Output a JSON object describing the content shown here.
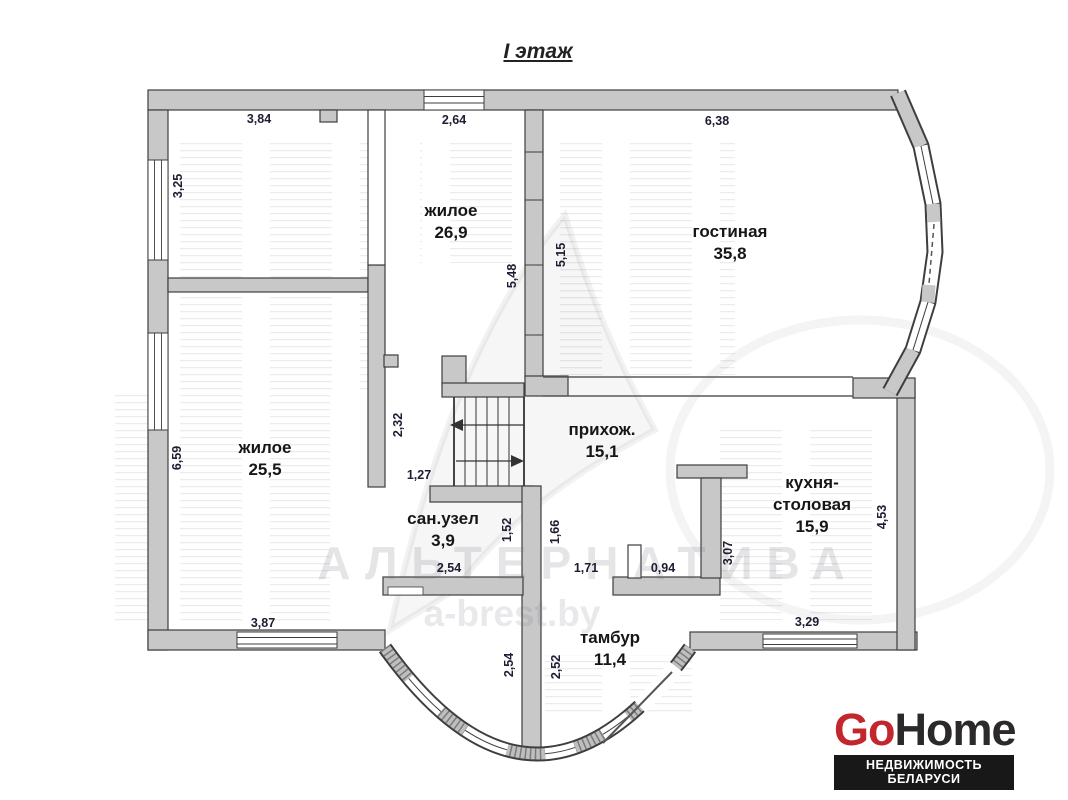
{
  "title": "I этаж",
  "rooms": [
    {
      "name": "жилое",
      "area": "26,9"
    },
    {
      "name": "гостиная",
      "area": "35,8"
    },
    {
      "name": "жилое",
      "area": "25,5"
    },
    {
      "name": "прихож.",
      "area": "15,1"
    },
    {
      "name": "сан.узел",
      "area": "3,9"
    },
    {
      "name": "кухня-",
      "name2": "столовая",
      "area": "15,9"
    },
    {
      "name": "тамбур",
      "area": "11,4"
    }
  ],
  "dims": [
    {
      "v": "3,84"
    },
    {
      "v": "2,64"
    },
    {
      "v": "6,38"
    },
    {
      "v": "3,25"
    },
    {
      "v": "6,59"
    },
    {
      "v": "5,48"
    },
    {
      "v": "5,15"
    },
    {
      "v": "2,32"
    },
    {
      "v": "1,27"
    },
    {
      "v": "1,52"
    },
    {
      "v": "1,66"
    },
    {
      "v": "2,54"
    },
    {
      "v": "1,71"
    },
    {
      "v": "0,94"
    },
    {
      "v": "3,07"
    },
    {
      "v": "4,53"
    },
    {
      "v": "3,87"
    },
    {
      "v": "3,29"
    },
    {
      "v": "2,54"
    },
    {
      "v": "2,52"
    }
  ],
  "watermark": {
    "brand": "АЛЬТЕРНАТИВА",
    "site": "a-brest.by"
  },
  "logo": {
    "go": "Go",
    "home": "Home",
    "tagline": "НЕДВИЖИМОСТЬ БЕЛАРУСИ"
  },
  "colors": {
    "wall_fill": "#c8c8c8",
    "wall_stroke": "#3e3e3e",
    "logo_red": "#c1272d",
    "logo_dark": "#2b2929",
    "tagline_bg": "#181818",
    "dim_text": "#1d1d33",
    "room_text": "#161616"
  }
}
